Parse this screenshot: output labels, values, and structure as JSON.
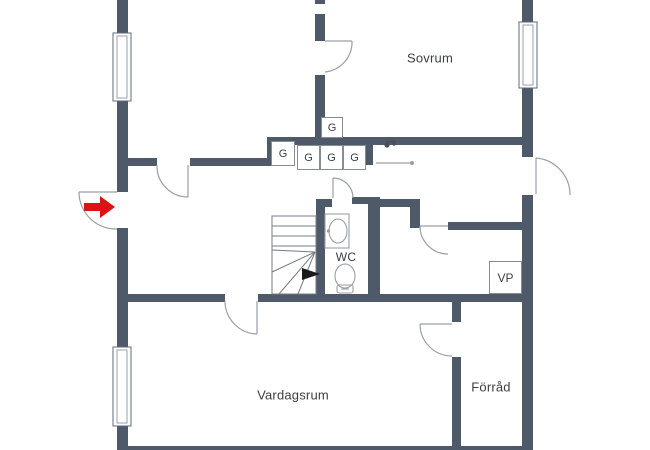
{
  "floorplan": {
    "room_labels": {
      "bedroom": "Sovrum",
      "toilet": "WC",
      "heating_unit": "VP",
      "living_room": "Vardagsrum",
      "storage": "Förråd"
    },
    "closet_labels": [
      "G",
      "G",
      "G",
      "G",
      "G"
    ],
    "icons": {
      "entrance_arrow": "red-right-arrow",
      "stair_direction": "black-right-arrow",
      "toilet": "toilet-symbol",
      "sink": "sink-symbol"
    },
    "colors": {
      "wall": "#4e5a6a",
      "thin_line": "#9a9fa6",
      "stair_line": "#777c82",
      "entry_arrow": "#dd1212",
      "stair_arrow": "#1a1a1a",
      "text": "#3b4046",
      "background": "#ffffff",
      "fixture": "#4a4f55"
    }
  }
}
